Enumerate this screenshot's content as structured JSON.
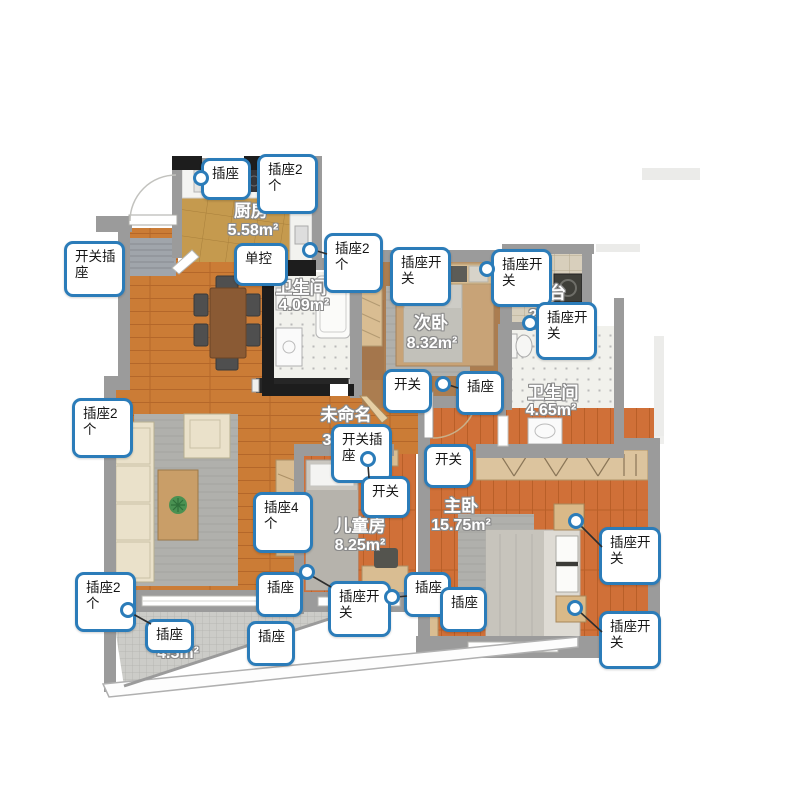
{
  "meta": {
    "app_view": "floorplan-canvas",
    "canvas_w": 800,
    "canvas_h": 800
  },
  "colors": {
    "callout_border": "#2b7cb9",
    "wall": "#9b9b9b",
    "wall_dark": "#1d1d1d",
    "living_floor": "#cb7c36",
    "bedroom_floor": "#d07038",
    "kitchen_floor": "#c59a4e",
    "bath_floor": "#f1f1ec",
    "balcony_tile": "#ccccc8",
    "leader_line": "#2e2e2e",
    "label_text": "#ffffff",
    "label_outline": "#8a8a8a"
  },
  "rooms": [
    {
      "id": "kitchen",
      "name": "厨房",
      "area": "5.58m²",
      "name_x": 251,
      "name_y": 209,
      "area_x": 253,
      "area_y": 231
    },
    {
      "id": "bath-1",
      "name": "卫生间",
      "area": "4.09m²",
      "name_x": 301,
      "name_y": 286,
      "area_x": 304,
      "area_y": 306
    },
    {
      "id": "bedroom-2",
      "name": "次卧",
      "area": "8.32m²",
      "name_x": 431,
      "name_y": 321,
      "area_x": 432,
      "area_y": 344
    },
    {
      "id": "balcony-top",
      "name": "阳台",
      "area": "2",
      "name_x": 549,
      "name_y": 291,
      "area_x": 533,
      "area_y": 316
    },
    {
      "id": "bath-2",
      "name": "卫生间",
      "area": "4.65m²",
      "name_x": 553,
      "name_y": 391,
      "area_x": 551,
      "area_y": 411
    },
    {
      "id": "unnamed",
      "name": "未命名",
      "area": "3",
      "name_x": 346,
      "name_y": 413,
      "area_x": 327,
      "area_y": 441
    },
    {
      "id": "kids-room",
      "name": "儿童房",
      "area": "8.25m²",
      "name_x": 360,
      "name_y": 524,
      "area_x": 360,
      "area_y": 546
    },
    {
      "id": "master-bedroom",
      "name": "主卧",
      "area": "15.75m²",
      "name_x": 461,
      "name_y": 504,
      "area_x": 461,
      "area_y": 526
    },
    {
      "id": "balcony-bottom",
      "name": "",
      "area": "4.5m²",
      "name_x": 178,
      "name_y": 630,
      "area_x": 178,
      "area_y": 654
    }
  ],
  "callouts": [
    {
      "label": "插座",
      "x": 201,
      "y": 158,
      "w": 50,
      "h": 42
    },
    {
      "label": "插座2个",
      "x": 257,
      "y": 154,
      "w": 61,
      "h": 60
    },
    {
      "label": "开关插座",
      "x": 64,
      "y": 241,
      "w": 61,
      "h": 56
    },
    {
      "label": "单控",
      "x": 234,
      "y": 243,
      "w": 54,
      "h": 43
    },
    {
      "label": "插座2个",
      "x": 324,
      "y": 233,
      "w": 59,
      "h": 60
    },
    {
      "label": "插座开关",
      "x": 390,
      "y": 247,
      "w": 61,
      "h": 59
    },
    {
      "label": "插座开关",
      "x": 491,
      "y": 249,
      "w": 61,
      "h": 58
    },
    {
      "label": "插座开关",
      "x": 536,
      "y": 302,
      "w": 61,
      "h": 58
    },
    {
      "label": "开关",
      "x": 383,
      "y": 369,
      "w": 49,
      "h": 44
    },
    {
      "label": "插座",
      "x": 456,
      "y": 371,
      "w": 48,
      "h": 44
    },
    {
      "label": "插座2个",
      "x": 72,
      "y": 398,
      "w": 61,
      "h": 60
    },
    {
      "label": "开关插座",
      "x": 331,
      "y": 424,
      "w": 61,
      "h": 59
    },
    {
      "label": "开关",
      "x": 361,
      "y": 476,
      "w": 49,
      "h": 42
    },
    {
      "label": "开关",
      "x": 424,
      "y": 444,
      "w": 49,
      "h": 44
    },
    {
      "label": "插座4个",
      "x": 253,
      "y": 492,
      "w": 60,
      "h": 61
    },
    {
      "label": "插座开关",
      "x": 599,
      "y": 527,
      "w": 62,
      "h": 58
    },
    {
      "label": "插座",
      "x": 404,
      "y": 572,
      "w": 47,
      "h": 45
    },
    {
      "label": "插座",
      "x": 440,
      "y": 587,
      "w": 47,
      "h": 45
    },
    {
      "label": "插座开关",
      "x": 328,
      "y": 581,
      "w": 63,
      "h": 56
    },
    {
      "label": "插座2个",
      "x": 75,
      "y": 572,
      "w": 61,
      "h": 60
    },
    {
      "label": "插座",
      "x": 145,
      "y": 619,
      "w": 49,
      "h": 34
    },
    {
      "label": "插座",
      "x": 247,
      "y": 621,
      "w": 48,
      "h": 45
    },
    {
      "label": "插座",
      "x": 256,
      "y": 572,
      "w": 47,
      "h": 45
    },
    {
      "label": "插座开关",
      "x": 599,
      "y": 611,
      "w": 62,
      "h": 58
    }
  ],
  "anchors": [
    {
      "x": 201,
      "y": 178
    },
    {
      "x": 310,
      "y": 250
    },
    {
      "x": 487,
      "y": 269
    },
    {
      "x": 530,
      "y": 323
    },
    {
      "x": 443,
      "y": 384
    },
    {
      "x": 368,
      "y": 459
    },
    {
      "x": 307,
      "y": 572
    },
    {
      "x": 392,
      "y": 597
    },
    {
      "x": 576,
      "y": 521
    },
    {
      "x": 575,
      "y": 608
    },
    {
      "x": 128,
      "y": 610
    }
  ],
  "leaders": [
    {
      "x1": 317,
      "y1": 251,
      "x2": 327,
      "y2": 254
    },
    {
      "x1": 449,
      "y1": 385,
      "x2": 458,
      "y2": 388
    },
    {
      "x1": 368,
      "y1": 465,
      "x2": 369,
      "y2": 478
    },
    {
      "x1": 312,
      "y1": 576,
      "x2": 331,
      "y2": 587
    },
    {
      "x1": 397,
      "y1": 597,
      "x2": 407,
      "y2": 596
    },
    {
      "x1": 581,
      "y1": 526,
      "x2": 602,
      "y2": 547
    },
    {
      "x1": 580,
      "y1": 612,
      "x2": 602,
      "y2": 632
    },
    {
      "x1": 133,
      "y1": 614,
      "x2": 151,
      "y2": 624
    }
  ]
}
